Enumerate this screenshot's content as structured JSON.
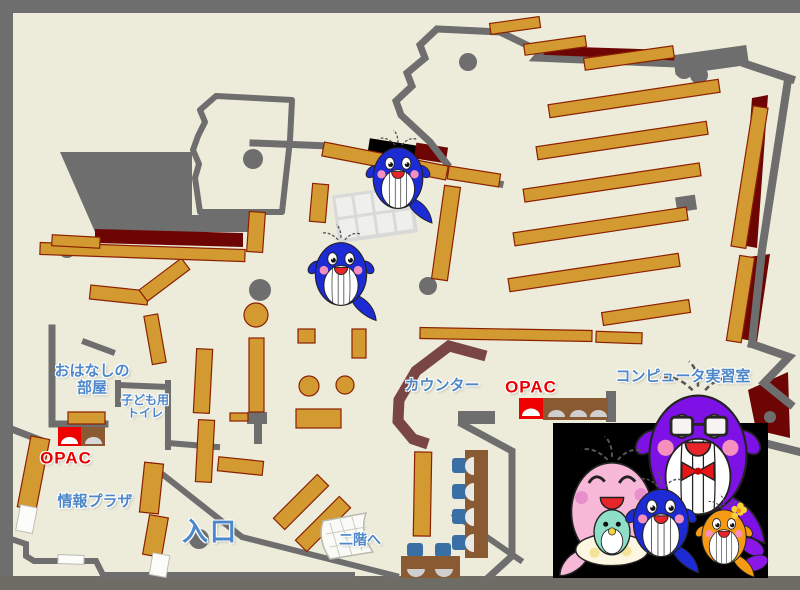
{
  "map": {
    "title": "library-floor-map",
    "labels": {
      "story_room_line1": "おはなしの",
      "story_room_line2": "部屋",
      "kids_toilet_line1": "子ども用",
      "kids_toilet_line2": "トイレ",
      "opac_left": "OPAC",
      "opac_right": "OPAC",
      "info_plaza": "情報プラザ",
      "entrance": "入口",
      "counter": "カウンター",
      "computer_room": "コンピュータ実習室",
      "to_second_floor": "二階へ"
    },
    "colors": {
      "background": "#4a4a41",
      "floor": "#edecdb",
      "wall_gray": "#6e6e6e",
      "shelf_orange": "#d49a32",
      "shelf_border": "#8b2000",
      "dark_red": "#6e0505",
      "counter_maroon": "#7a4545",
      "label_blue": "#4d87c9",
      "opac_red": "#e80000",
      "desk_brown": "#8a5a33",
      "chair_blue": "#3a6fa5",
      "panel_black": "#000000",
      "whale_blue": "#1c2bd4",
      "whale_pink": "#f8b8d8",
      "whale_purple": "#7e11e6",
      "whale_orange": "#f49a15",
      "baby_teal": "#8fdec8"
    },
    "icons": [
      "whale-mascot-icon",
      "whale-family-icon",
      "stairs-icon",
      "pillar-icon",
      "opac-terminal-icon"
    ]
  }
}
